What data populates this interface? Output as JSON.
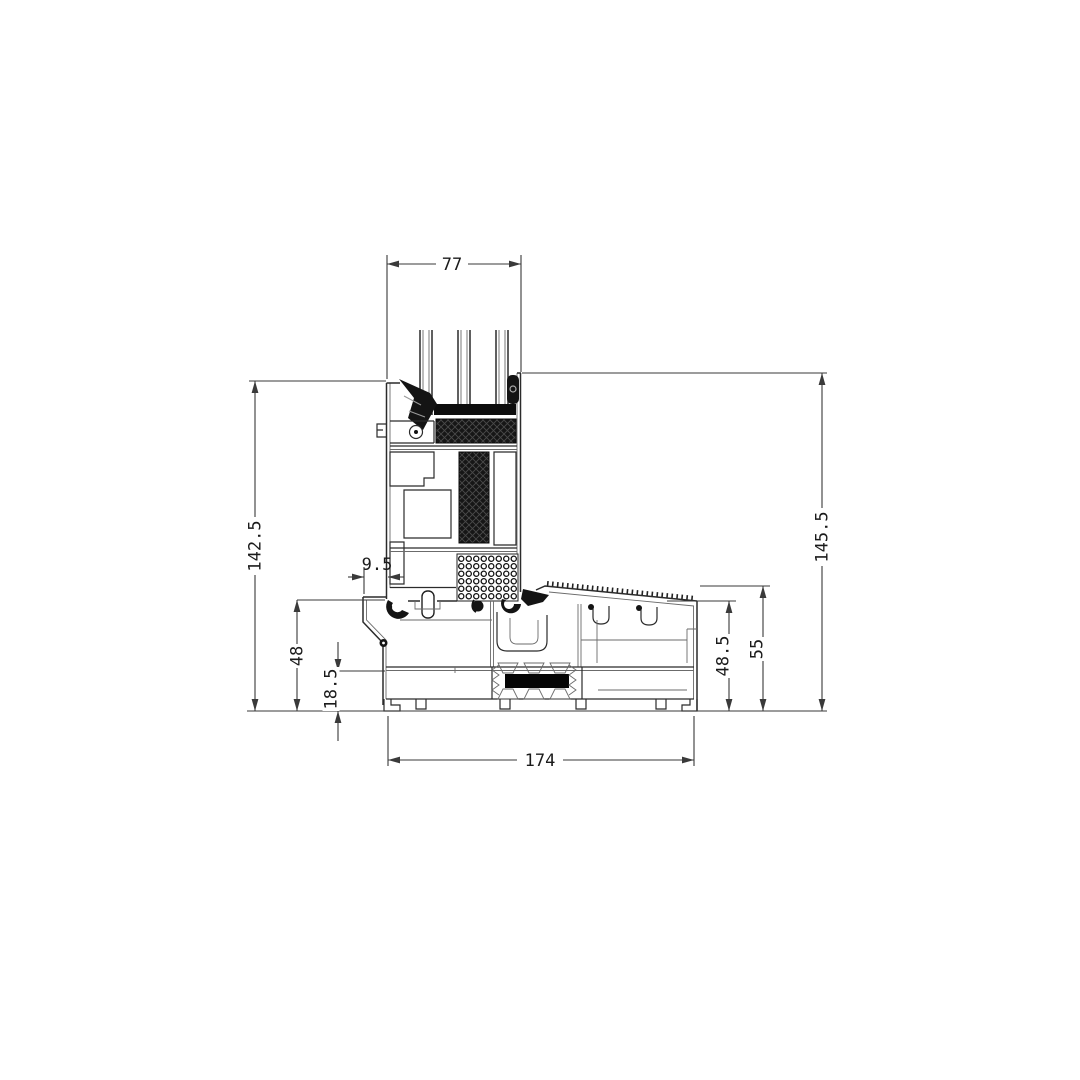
{
  "page": {
    "background": "#ffffff"
  },
  "drawing": {
    "kind": "window-threshold-cross-section",
    "line_color": "#2b2b2b",
    "dim_color": "#3a3a3a",
    "dimensions": {
      "top_width": "77",
      "left_overall_height": "142.5",
      "right_overall_height": "145.5",
      "lip_offset": "9.5",
      "sill_left_height": "48",
      "sill_lower_height": "18.5",
      "sill_right_inner_height": "48.5",
      "sill_right_outer_height": "55",
      "overall_width": "174"
    }
  }
}
